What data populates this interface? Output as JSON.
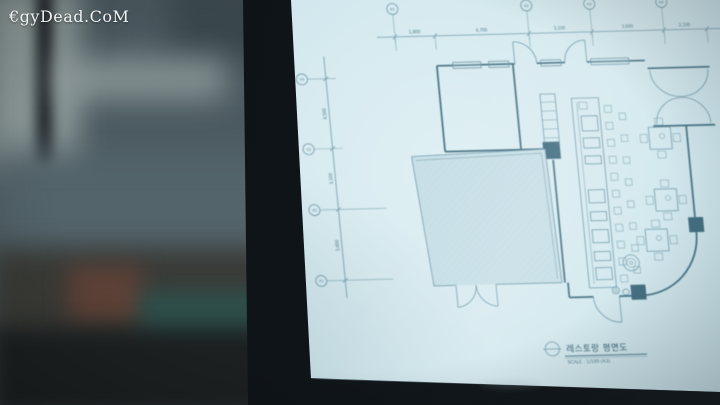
{
  "watermark": "€gyDead.CoM",
  "screen": {
    "drawing": {
      "title": "레스토랑 평면도",
      "scale_note": "SCALE : 1/100 (A3)",
      "grid_labels_top": [
        "X1",
        "X2",
        "X3",
        "X4"
      ],
      "grid_labels_left": [
        "Y4",
        "Y3",
        "Y2",
        "Y1"
      ],
      "dims_top": [
        "1,800",
        "4,700",
        "3,100",
        "3,600",
        "2,100"
      ],
      "dims_left": [
        "4,500",
        "3,100",
        "3,600"
      ]
    }
  }
}
